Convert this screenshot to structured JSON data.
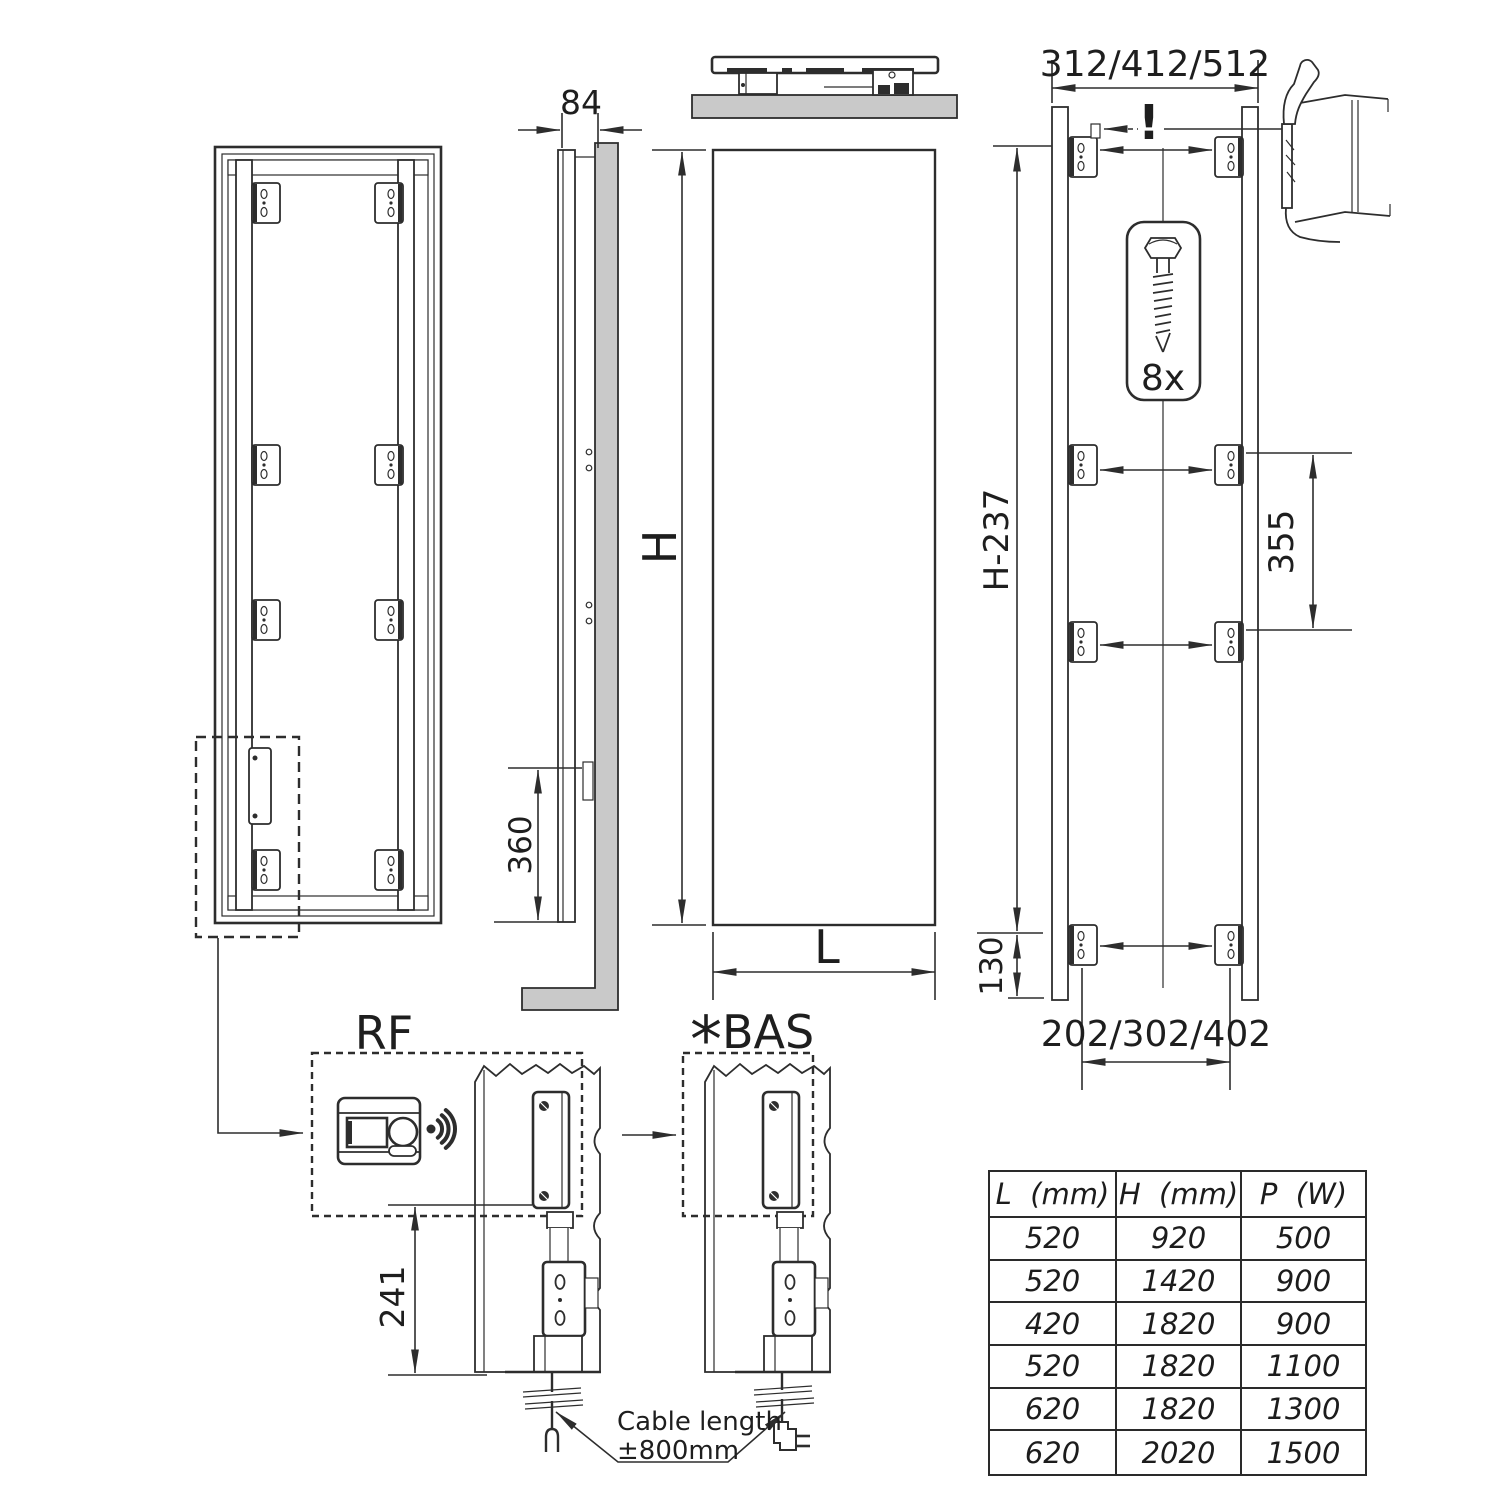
{
  "labels": {
    "rf": "RF",
    "bas_star": "*",
    "bas": "BAS",
    "warning": "!",
    "screw_count": "8x",
    "cable_note_line1": "Cable length",
    "cable_note_line2": "±800mm"
  },
  "dims": {
    "depth": "84",
    "height": "H",
    "width": "L",
    "cable_exit_height": "360",
    "top_hole_spacing": "312/412/512",
    "bracket_extent": "H-237",
    "mid_hole_spacing": "355",
    "bottom_offset": "130",
    "bottom_hole_spacing": "202/302/402",
    "module_height": "241"
  },
  "table": {
    "headers": [
      "L  (mm)",
      "H  (mm)",
      "P  (W)"
    ],
    "rows": [
      [
        "520",
        "920",
        "500"
      ],
      [
        "520",
        "1420",
        "900"
      ],
      [
        "420",
        "1820",
        "900"
      ],
      [
        "520",
        "1820",
        "1100"
      ],
      [
        "620",
        "1820",
        "1300"
      ],
      [
        "620",
        "2020",
        "1500"
      ]
    ]
  }
}
